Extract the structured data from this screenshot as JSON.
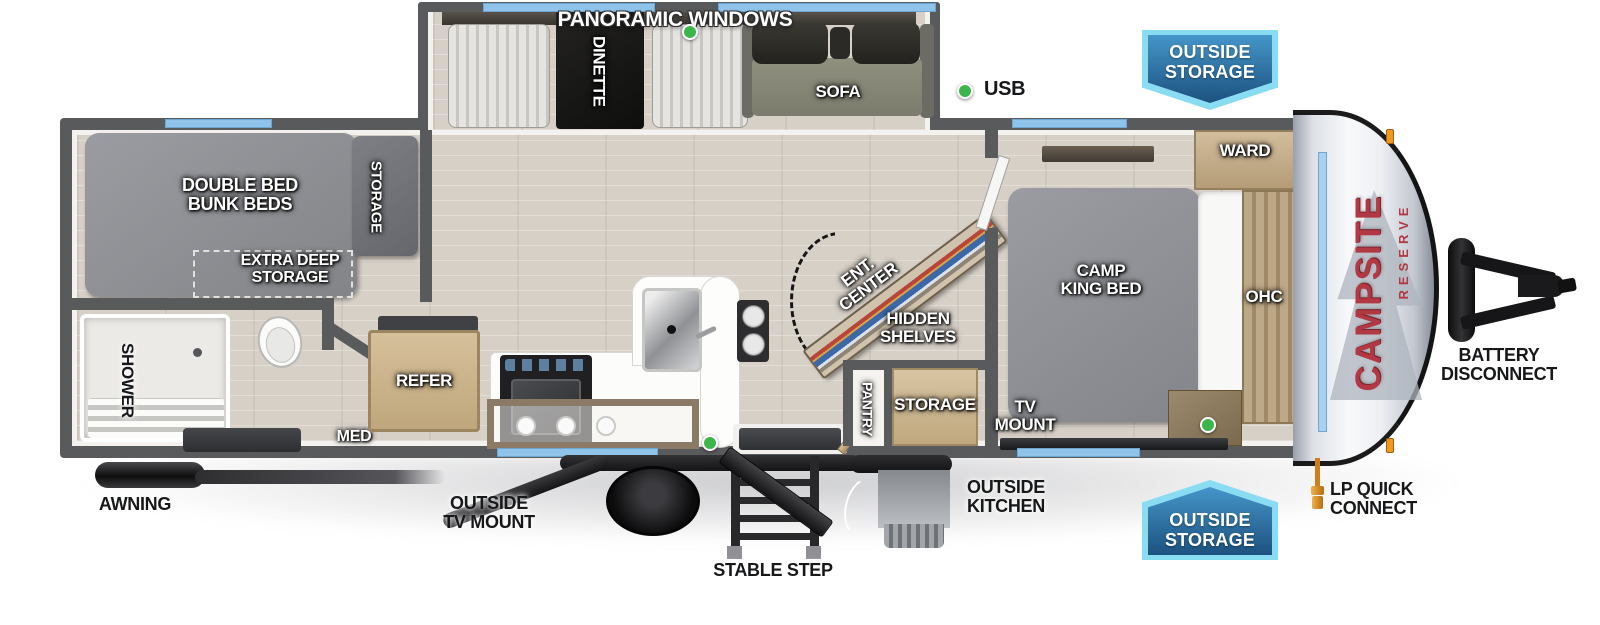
{
  "title": "Campsite Reserve Travel Trailer Floorplan",
  "brand": {
    "name": "CAMPSITE",
    "series": "RESERVE"
  },
  "legend": {
    "usb_marker_color": "#3cb54a",
    "window_color": "#8fc3e9",
    "wall_color": "#595a5c",
    "badge_border": "#8adcf2",
    "badge_fill": "#1c527f",
    "logo_red": "#b23943"
  },
  "labels": {
    "panoramic_windows": "PANORAMIC WINDOWS",
    "dinette": "DINETTE",
    "sofa": "SOFA",
    "usb": "USB",
    "outside_storage": {
      "l1": "OUTSIDE",
      "l2": "STORAGE"
    },
    "ward": "WARD",
    "double_bed_bunk": {
      "l1": "DOUBLE BED",
      "l2": "BUNK BEDS"
    },
    "bunk_storage": "STORAGE",
    "extra_deep_storage": {
      "l1": "EXTRA DEEP",
      "l2": "STORAGE"
    },
    "ent_center": {
      "l1": "ENT.",
      "l2": "CENTER"
    },
    "hidden_shelves": {
      "l1": "HIDDEN",
      "l2": "SHELVES"
    },
    "camp_king_bed": {
      "l1": "CAMP",
      "l2": "KING BED"
    },
    "ohc": "OHC",
    "shower": "SHOWER",
    "med": "MED",
    "refer": "REFER",
    "pantry": "PANTRY",
    "entry_storage": "STORAGE",
    "tv_mount": {
      "l1": "TV",
      "l2": "MOUNT"
    },
    "awning": "AWNING",
    "outside_tv_mount": {
      "l1": "OUTSIDE",
      "l2": "TV MOUNT"
    },
    "stable_step": "STABLE STEP",
    "outside_kitchen": {
      "l1": "OUTSIDE",
      "l2": "KITCHEN"
    },
    "lp_quick_connect": {
      "l1": "LP QUICK",
      "l2": "CONNECT"
    },
    "battery_disconnect": {
      "l1": "BATTERY",
      "l2": "DISCONNECT"
    }
  }
}
